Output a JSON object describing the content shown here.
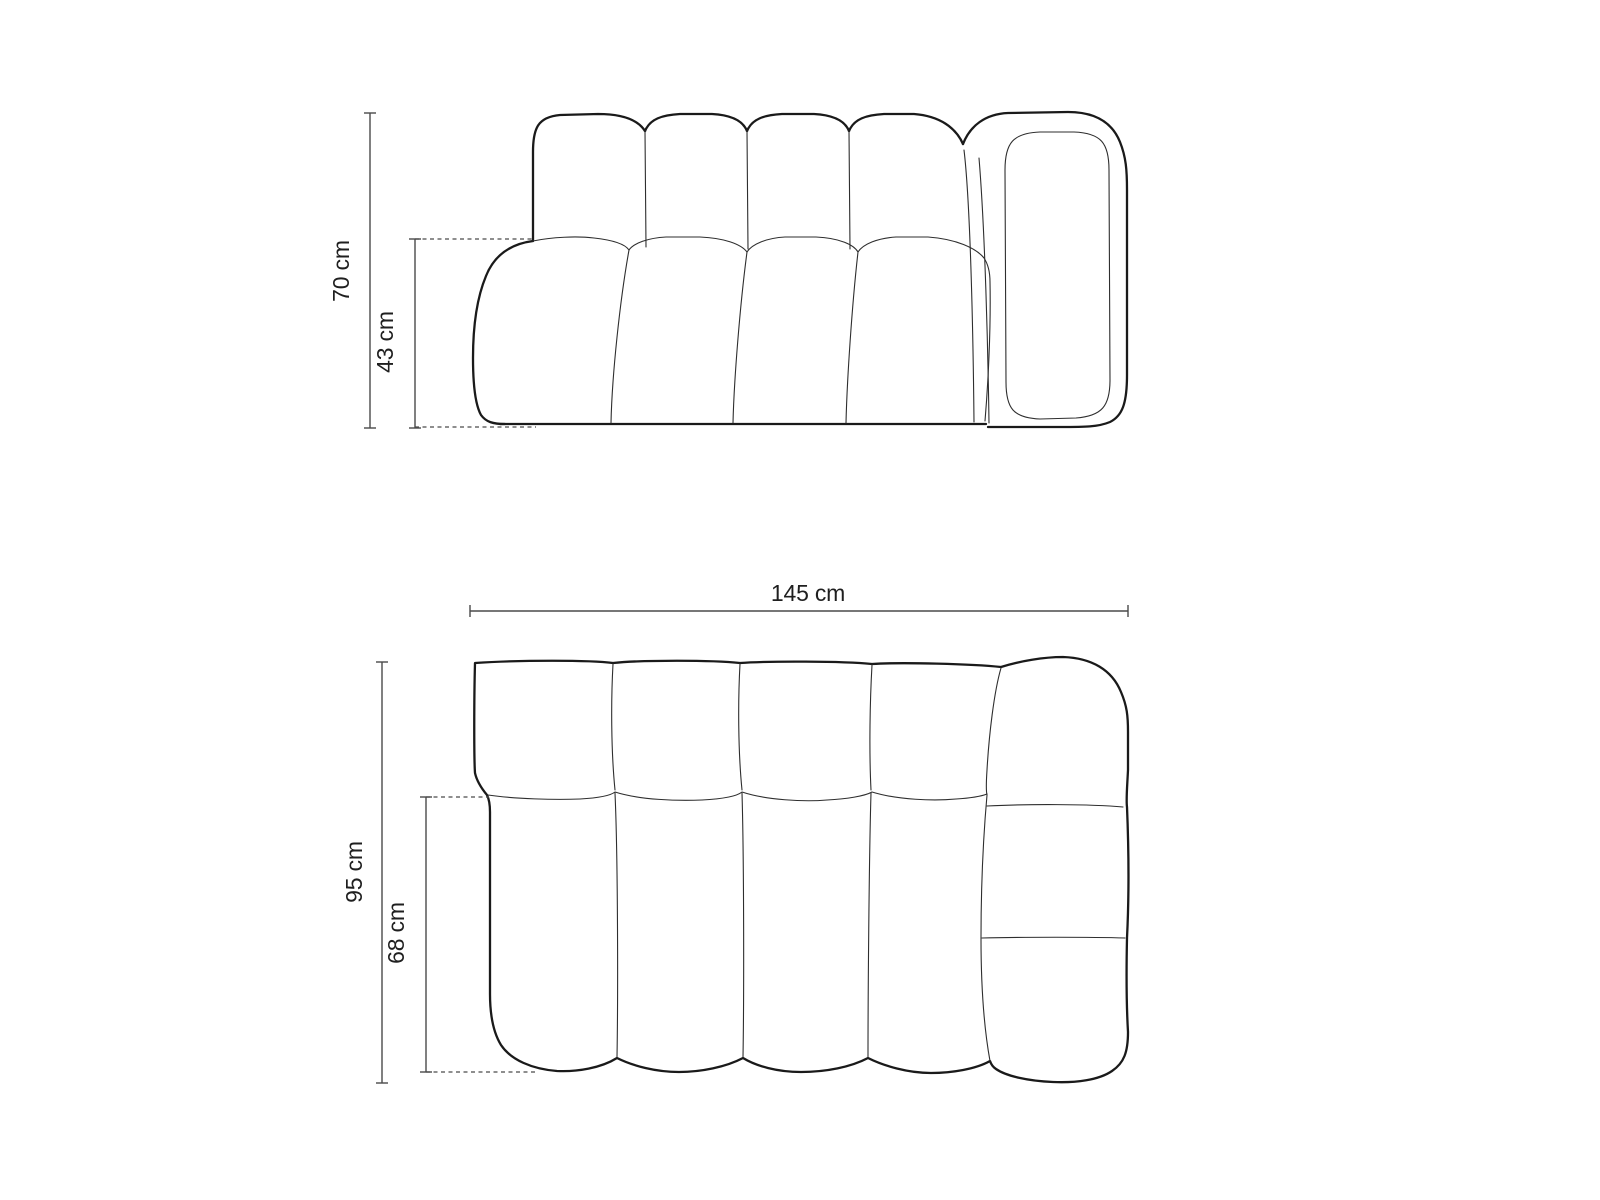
{
  "diagram": {
    "kind": "sofa-module-dimension-drawing",
    "views": {
      "elevation": {
        "id": "front-elevation",
        "dimensions": [
          {
            "id": "total-height",
            "label": "70 cm"
          },
          {
            "id": "seat-height",
            "label": "43 cm"
          }
        ]
      },
      "plan": {
        "id": "top-plan",
        "dimensions": [
          {
            "id": "total-width",
            "label": "145 cm"
          },
          {
            "id": "total-depth",
            "label": "95 cm"
          },
          {
            "id": "seat-depth",
            "label": "68 cm"
          }
        ]
      }
    },
    "colors": {
      "outline": "#1a1a1a",
      "seam": "#2e2e2e",
      "dimension": "#4a4a4a",
      "text": "#1f1f1f",
      "background": "#ffffff"
    }
  }
}
